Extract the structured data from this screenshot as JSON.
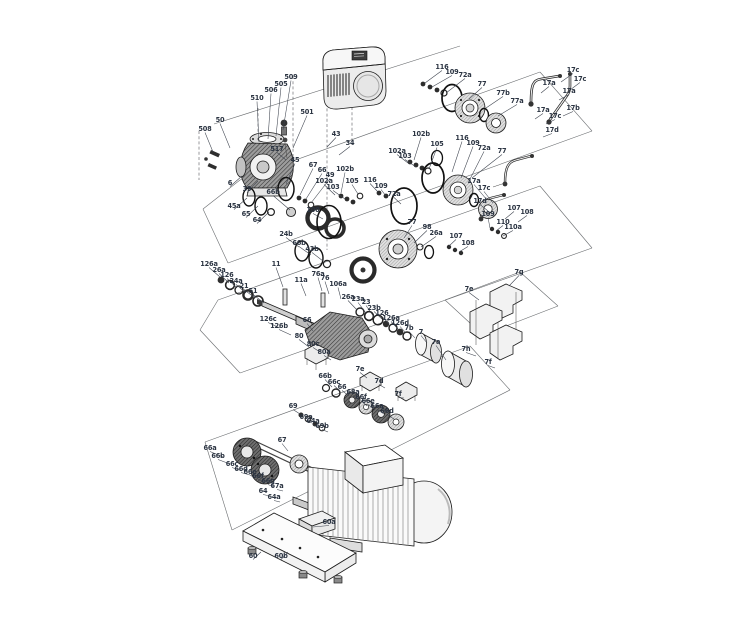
{
  "diagram": {
    "type": "exploded-parts-diagram",
    "subject": "pump assembly with motor, shaft seal kits, sensor pipes, couplings, motor and baseplate",
    "background_color": "#ffffff",
    "construction_line_color": "#6a6d70",
    "label_color": "#2b3442",
    "labels": [
      {
        "t": "508",
        "x": 205,
        "y": 131,
        "lx": 213,
        "ly": 152
      },
      {
        "t": "50",
        "x": 220,
        "y": 122,
        "lx": 230,
        "ly": 148
      },
      {
        "t": "510",
        "x": 257,
        "y": 100,
        "lx": 259,
        "ly": 142
      },
      {
        "t": "506",
        "x": 271,
        "y": 92,
        "lx": 268,
        "ly": 139
      },
      {
        "t": "505",
        "x": 281,
        "y": 86,
        "lx": 276,
        "ly": 136
      },
      {
        "t": "509",
        "x": 291,
        "y": 79,
        "lx": 283,
        "ly": 130
      },
      {
        "t": "501",
        "x": 307,
        "y": 114,
        "lx": 293,
        "ly": 148
      },
      {
        "t": "517",
        "x": 277,
        "y": 151,
        "lx": 286,
        "ly": 160
      },
      {
        "t": "6",
        "x": 230,
        "y": 185,
        "lx": 242,
        "ly": 176
      },
      {
        "t": "39",
        "x": 247,
        "y": 191,
        "lx": 258,
        "ly": 181
      },
      {
        "t": "43",
        "x": 336,
        "y": 136,
        "lx": 327,
        "ly": 147
      },
      {
        "t": "34",
        "x": 350,
        "y": 145,
        "lx": 339,
        "ly": 155
      },
      {
        "t": "45a",
        "x": 234,
        "y": 208,
        "lx": 247,
        "ly": 198
      },
      {
        "t": "65",
        "x": 246,
        "y": 216,
        "lx": 258,
        "ly": 206
      },
      {
        "t": "64",
        "x": 257,
        "y": 222,
        "lx": 269,
        "ly": 212
      },
      {
        "t": "45",
        "x": 295,
        "y": 162,
        "lx": 286,
        "ly": 184
      },
      {
        "t": "67",
        "x": 313,
        "y": 167,
        "lx": 300,
        "ly": 195
      },
      {
        "t": "66",
        "x": 322,
        "y": 172,
        "lx": 306,
        "ly": 199
      },
      {
        "t": "49",
        "x": 330,
        "y": 177,
        "lx": 311,
        "ly": 203
      },
      {
        "t": "66b",
        "x": 273,
        "y": 194,
        "lx": 290,
        "ly": 210
      },
      {
        "t": "100",
        "x": 313,
        "y": 212,
        "lx": 323,
        "ly": 219
      },
      {
        "t": "24b",
        "x": 286,
        "y": 236,
        "lx": 299,
        "ly": 247
      },
      {
        "t": "66b",
        "x": 299,
        "y": 245,
        "lx": 311,
        "ly": 255
      },
      {
        "t": "43b",
        "x": 312,
        "y": 251,
        "lx": 323,
        "ly": 261
      },
      {
        "t": "102b",
        "x": 345,
        "y": 171,
        "lx": 341,
        "ly": 193
      },
      {
        "t": "102a",
        "x": 324,
        "y": 183,
        "lx": 335,
        "ly": 195
      },
      {
        "t": "103",
        "x": 333,
        "y": 189,
        "lx": 345,
        "ly": 199
      },
      {
        "t": "105",
        "x": 352,
        "y": 183,
        "lx": 358,
        "ly": 194
      },
      {
        "t": "116",
        "x": 370,
        "y": 182,
        "lx": 378,
        "ly": 192
      },
      {
        "t": "109",
        "x": 381,
        "y": 188,
        "lx": 386,
        "ly": 196
      },
      {
        "t": "72a",
        "x": 394,
        "y": 196,
        "lx": 401,
        "ly": 204
      },
      {
        "t": "102b",
        "x": 421,
        "y": 136,
        "lx": 414,
        "ly": 160
      },
      {
        "t": "102a",
        "x": 397,
        "y": 153,
        "lx": 408,
        "ly": 163
      },
      {
        "t": "103",
        "x": 405,
        "y": 158,
        "lx": 416,
        "ly": 167
      },
      {
        "t": "105",
        "x": 437,
        "y": 146,
        "lx": 429,
        "ly": 169
      },
      {
        "t": "116",
        "x": 462,
        "y": 140,
        "lx": 452,
        "ly": 172
      },
      {
        "t": "109",
        "x": 473,
        "y": 145,
        "lx": 461,
        "ly": 178
      },
      {
        "t": "72a",
        "x": 484,
        "y": 150,
        "lx": 468,
        "ly": 183
      },
      {
        "t": "116",
        "x": 442,
        "y": 69,
        "lx": 425,
        "ly": 83
      },
      {
        "t": "109",
        "x": 452,
        "y": 74,
        "lx": 432,
        "ly": 87
      },
      {
        "t": "72a",
        "x": 465,
        "y": 77,
        "lx": 446,
        "ly": 93
      },
      {
        "t": "77",
        "x": 482,
        "y": 86,
        "lx": 469,
        "ly": 99
      },
      {
        "t": "77b",
        "x": 503,
        "y": 95,
        "lx": 486,
        "ly": 108
      },
      {
        "t": "77a",
        "x": 517,
        "y": 103,
        "lx": 498,
        "ly": 116
      },
      {
        "t": "77",
        "x": 502,
        "y": 153,
        "lx": 472,
        "ly": 178
      },
      {
        "t": "77",
        "x": 412,
        "y": 224,
        "lx": 404,
        "ly": 238
      },
      {
        "t": "98",
        "x": 427,
        "y": 229,
        "lx": 414,
        "ly": 243
      },
      {
        "t": "26a",
        "x": 436,
        "y": 235,
        "lx": 421,
        "ly": 247
      },
      {
        "t": "17c",
        "x": 573,
        "y": 72,
        "lx": 561,
        "ly": 82
      },
      {
        "t": "17a",
        "x": 549,
        "y": 85,
        "lx": 541,
        "ly": 93
      },
      {
        "t": "17c",
        "x": 580,
        "y": 81,
        "lx": 570,
        "ly": 90
      },
      {
        "t": "17a",
        "x": 569,
        "y": 93,
        "lx": 559,
        "ly": 100
      },
      {
        "t": "17b",
        "x": 573,
        "y": 110,
        "lx": 563,
        "ly": 116
      },
      {
        "t": "17a",
        "x": 543,
        "y": 112,
        "lx": 535,
        "ly": 119
      },
      {
        "t": "17c",
        "x": 555,
        "y": 118,
        "lx": 546,
        "ly": 124
      },
      {
        "t": "17d",
        "x": 552,
        "y": 132,
        "lx": 543,
        "ly": 137
      },
      {
        "t": "17a",
        "x": 474,
        "y": 183,
        "lx": 487,
        "ly": 200
      },
      {
        "t": "17c",
        "x": 484,
        "y": 190,
        "lx": 493,
        "ly": 203
      },
      {
        "t": "17d",
        "x": 480,
        "y": 203,
        "lx": 488,
        "ly": 211
      },
      {
        "t": "107",
        "x": 514,
        "y": 210,
        "lx": 505,
        "ly": 219
      },
      {
        "t": "108",
        "x": 527,
        "y": 214,
        "lx": 518,
        "ly": 222
      },
      {
        "t": "109",
        "x": 488,
        "y": 216,
        "lx": 490,
        "ly": 228
      },
      {
        "t": "110",
        "x": 503,
        "y": 224,
        "lx": 496,
        "ly": 231
      },
      {
        "t": "110a",
        "x": 513,
        "y": 229,
        "lx": 503,
        "ly": 236
      },
      {
        "t": "107",
        "x": 456,
        "y": 238,
        "lx": 449,
        "ly": 246
      },
      {
        "t": "108",
        "x": 468,
        "y": 245,
        "lx": 459,
        "ly": 252
      },
      {
        "t": "126a",
        "x": 209,
        "y": 266,
        "lx": 220,
        "ly": 277
      },
      {
        "t": "26a",
        "x": 219,
        "y": 272,
        "lx": 229,
        "ly": 283
      },
      {
        "t": "126",
        "x": 227,
        "y": 277,
        "lx": 237,
        "ly": 288
      },
      {
        "t": "24a",
        "x": 236,
        "y": 283,
        "lx": 246,
        "ly": 293
      },
      {
        "t": "21",
        "x": 244,
        "y": 288,
        "lx": 255,
        "ly": 298
      },
      {
        "t": "51",
        "x": 253,
        "y": 293,
        "lx": 264,
        "ly": 303
      },
      {
        "t": "11",
        "x": 276,
        "y": 266,
        "lx": 283,
        "ly": 287
      },
      {
        "t": "11a",
        "x": 301,
        "y": 282,
        "lx": 306,
        "ly": 296
      },
      {
        "t": "76a",
        "x": 318,
        "y": 276,
        "lx": 322,
        "ly": 291
      },
      {
        "t": "76",
        "x": 325,
        "y": 280,
        "lx": 329,
        "ly": 294
      },
      {
        "t": "106a",
        "x": 338,
        "y": 286,
        "lx": 341,
        "ly": 299
      },
      {
        "t": "26a",
        "x": 348,
        "y": 299,
        "lx": 357,
        "ly": 310
      },
      {
        "t": "23a",
        "x": 358,
        "y": 301,
        "lx": 366,
        "ly": 313
      },
      {
        "t": "23",
        "x": 366,
        "y": 304,
        "lx": 374,
        "ly": 317
      },
      {
        "t": "126c",
        "x": 268,
        "y": 321,
        "lx": 280,
        "ly": 328
      },
      {
        "t": "126b",
        "x": 279,
        "y": 328,
        "lx": 291,
        "ly": 335
      },
      {
        "t": "66",
        "x": 307,
        "y": 322,
        "lx": 313,
        "ly": 331
      },
      {
        "t": "80",
        "x": 299,
        "y": 338,
        "lx": 309,
        "ly": 347
      },
      {
        "t": "80c",
        "x": 313,
        "y": 346,
        "lx": 320,
        "ly": 352
      },
      {
        "t": "80a",
        "x": 324,
        "y": 354,
        "lx": 331,
        "ly": 360
      },
      {
        "t": "23b",
        "x": 374,
        "y": 310,
        "lx": 382,
        "ly": 319
      },
      {
        "t": "126",
        "x": 382,
        "y": 315,
        "lx": 389,
        "ly": 324
      },
      {
        "t": "126a",
        "x": 391,
        "y": 320,
        "lx": 398,
        "ly": 329
      },
      {
        "t": "126d",
        "x": 400,
        "y": 325,
        "lx": 406,
        "ly": 333
      },
      {
        "t": "7b",
        "x": 409,
        "y": 330,
        "lx": 415,
        "ly": 338
      },
      {
        "t": "7",
        "x": 421,
        "y": 334,
        "lx": 427,
        "ly": 343
      },
      {
        "t": "7a",
        "x": 436,
        "y": 344,
        "lx": 446,
        "ly": 360
      },
      {
        "t": "7g",
        "x": 519,
        "y": 274,
        "lx": 509,
        "ly": 286
      },
      {
        "t": "7e",
        "x": 469,
        "y": 291,
        "lx": 479,
        "ly": 300
      },
      {
        "t": "7h",
        "x": 466,
        "y": 351,
        "lx": 476,
        "ly": 356
      },
      {
        "t": "7f",
        "x": 488,
        "y": 364,
        "lx": 495,
        "ly": 368
      },
      {
        "t": "7e",
        "x": 360,
        "y": 371,
        "lx": 367,
        "ly": 378
      },
      {
        "t": "7d",
        "x": 379,
        "y": 383,
        "lx": 385,
        "ly": 388
      },
      {
        "t": "7f",
        "x": 398,
        "y": 396,
        "lx": 404,
        "ly": 398
      },
      {
        "t": "66b",
        "x": 325,
        "y": 378,
        "lx": 332,
        "ly": 387
      },
      {
        "t": "66c",
        "x": 334,
        "y": 384,
        "lx": 340,
        "ly": 391
      },
      {
        "t": "66",
        "x": 342,
        "y": 389,
        "lx": 349,
        "ly": 396
      },
      {
        "t": "68a",
        "x": 353,
        "y": 394,
        "lx": 359,
        "ly": 400
      },
      {
        "t": "66f",
        "x": 361,
        "y": 399,
        "lx": 367,
        "ly": 406
      },
      {
        "t": "66e",
        "x": 368,
        "y": 403,
        "lx": 375,
        "ly": 410
      },
      {
        "t": "66a",
        "x": 377,
        "y": 408,
        "lx": 384,
        "ly": 414
      },
      {
        "t": "66d",
        "x": 387,
        "y": 413,
        "lx": 394,
        "ly": 419
      },
      {
        "t": "69",
        "x": 293,
        "y": 408,
        "lx": 300,
        "ly": 414
      },
      {
        "t": "69a",
        "x": 306,
        "y": 419,
        "lx": 312,
        "ly": 423
      },
      {
        "t": "64a",
        "x": 313,
        "y": 423,
        "lx": 319,
        "ly": 427
      },
      {
        "t": "69b",
        "x": 322,
        "y": 428,
        "lx": 328,
        "ly": 432
      },
      {
        "t": "67",
        "x": 282,
        "y": 442,
        "lx": 288,
        "ly": 451
      },
      {
        "t": "66a",
        "x": 210,
        "y": 450,
        "lx": 223,
        "ly": 457
      },
      {
        "t": "66b",
        "x": 218,
        "y": 458,
        "lx": 230,
        "ly": 464
      },
      {
        "t": "66c",
        "x": 232,
        "y": 466,
        "lx": 242,
        "ly": 471
      },
      {
        "t": "66d",
        "x": 241,
        "y": 471,
        "lx": 250,
        "ly": 475
      },
      {
        "t": "66e",
        "x": 250,
        "y": 474,
        "lx": 258,
        "ly": 478
      },
      {
        "t": "66f",
        "x": 258,
        "y": 478,
        "lx": 265,
        "ly": 482
      },
      {
        "t": "66g",
        "x": 268,
        "y": 483,
        "lx": 274,
        "ly": 487
      },
      {
        "t": "67a",
        "x": 277,
        "y": 488,
        "lx": 283,
        "ly": 491
      },
      {
        "t": "64",
        "x": 263,
        "y": 493,
        "lx": 270,
        "ly": 496
      },
      {
        "t": "64a",
        "x": 274,
        "y": 499,
        "lx": 280,
        "ly": 502
      },
      {
        "t": "60a",
        "x": 329,
        "y": 524,
        "lx": 313,
        "ly": 527
      },
      {
        "t": "60",
        "x": 253,
        "y": 558,
        "lx": 261,
        "ly": 552
      },
      {
        "t": "60b",
        "x": 281,
        "y": 558,
        "lx": 288,
        "ly": 552
      }
    ],
    "lines": [
      {
        "x1": 240,
        "y1": 180,
        "x2": 540,
        "y2": 72,
        "dash": false
      },
      {
        "x1": 540,
        "y1": 72,
        "x2": 592,
        "y2": 131,
        "dash": false
      },
      {
        "x1": 228,
        "y1": 263,
        "x2": 592,
        "y2": 131,
        "dash": false
      },
      {
        "x1": 203,
        "y1": 209,
        "x2": 240,
        "y2": 180,
        "dash": false
      },
      {
        "x1": 203,
        "y1": 209,
        "x2": 228,
        "y2": 263,
        "dash": false
      },
      {
        "x1": 214,
        "y1": 124,
        "x2": 460,
        "y2": 46,
        "dash": false
      },
      {
        "x1": 218,
        "y1": 300,
        "x2": 540,
        "y2": 186,
        "dash": false
      },
      {
        "x1": 200,
        "y1": 330,
        "x2": 218,
        "y2": 300,
        "dash": false
      },
      {
        "x1": 200,
        "y1": 330,
        "x2": 240,
        "y2": 373,
        "dash": false
      },
      {
        "x1": 240,
        "y1": 373,
        "x2": 592,
        "y2": 248,
        "dash": false
      },
      {
        "x1": 540,
        "y1": 186,
        "x2": 592,
        "y2": 248,
        "dash": false
      },
      {
        "x1": 205,
        "y1": 442,
        "x2": 470,
        "y2": 346,
        "dash": false
      },
      {
        "x1": 232,
        "y1": 530,
        "x2": 510,
        "y2": 390,
        "dash": false
      },
      {
        "x1": 470,
        "y1": 346,
        "x2": 510,
        "y2": 390,
        "dash": false
      },
      {
        "x1": 205,
        "y1": 442,
        "x2": 232,
        "y2": 530,
        "dash": false
      },
      {
        "x1": 445,
        "y1": 300,
        "x2": 520,
        "y2": 272,
        "dash": false
      },
      {
        "x1": 520,
        "y1": 272,
        "x2": 558,
        "y2": 306,
        "dash": false
      },
      {
        "x1": 558,
        "y1": 306,
        "x2": 483,
        "y2": 335,
        "dash": false
      },
      {
        "x1": 483,
        "y1": 335,
        "x2": 445,
        "y2": 300,
        "dash": false
      },
      {
        "x1": 199,
        "y1": 131,
        "x2": 199,
        "y2": 180,
        "dash": true
      },
      {
        "x1": 293,
        "y1": 76,
        "x2": 293,
        "y2": 162,
        "dash": true
      },
      {
        "x1": 327,
        "y1": 98,
        "x2": 327,
        "y2": 250,
        "dash": true
      },
      {
        "x1": 352,
        "y1": 107,
        "x2": 352,
        "y2": 145,
        "dash": true
      },
      {
        "x1": 258,
        "y1": 108,
        "x2": 258,
        "y2": 134,
        "dash": true
      },
      {
        "x1": 330,
        "y1": 498,
        "x2": 330,
        "y2": 556,
        "dash": true
      }
    ]
  }
}
